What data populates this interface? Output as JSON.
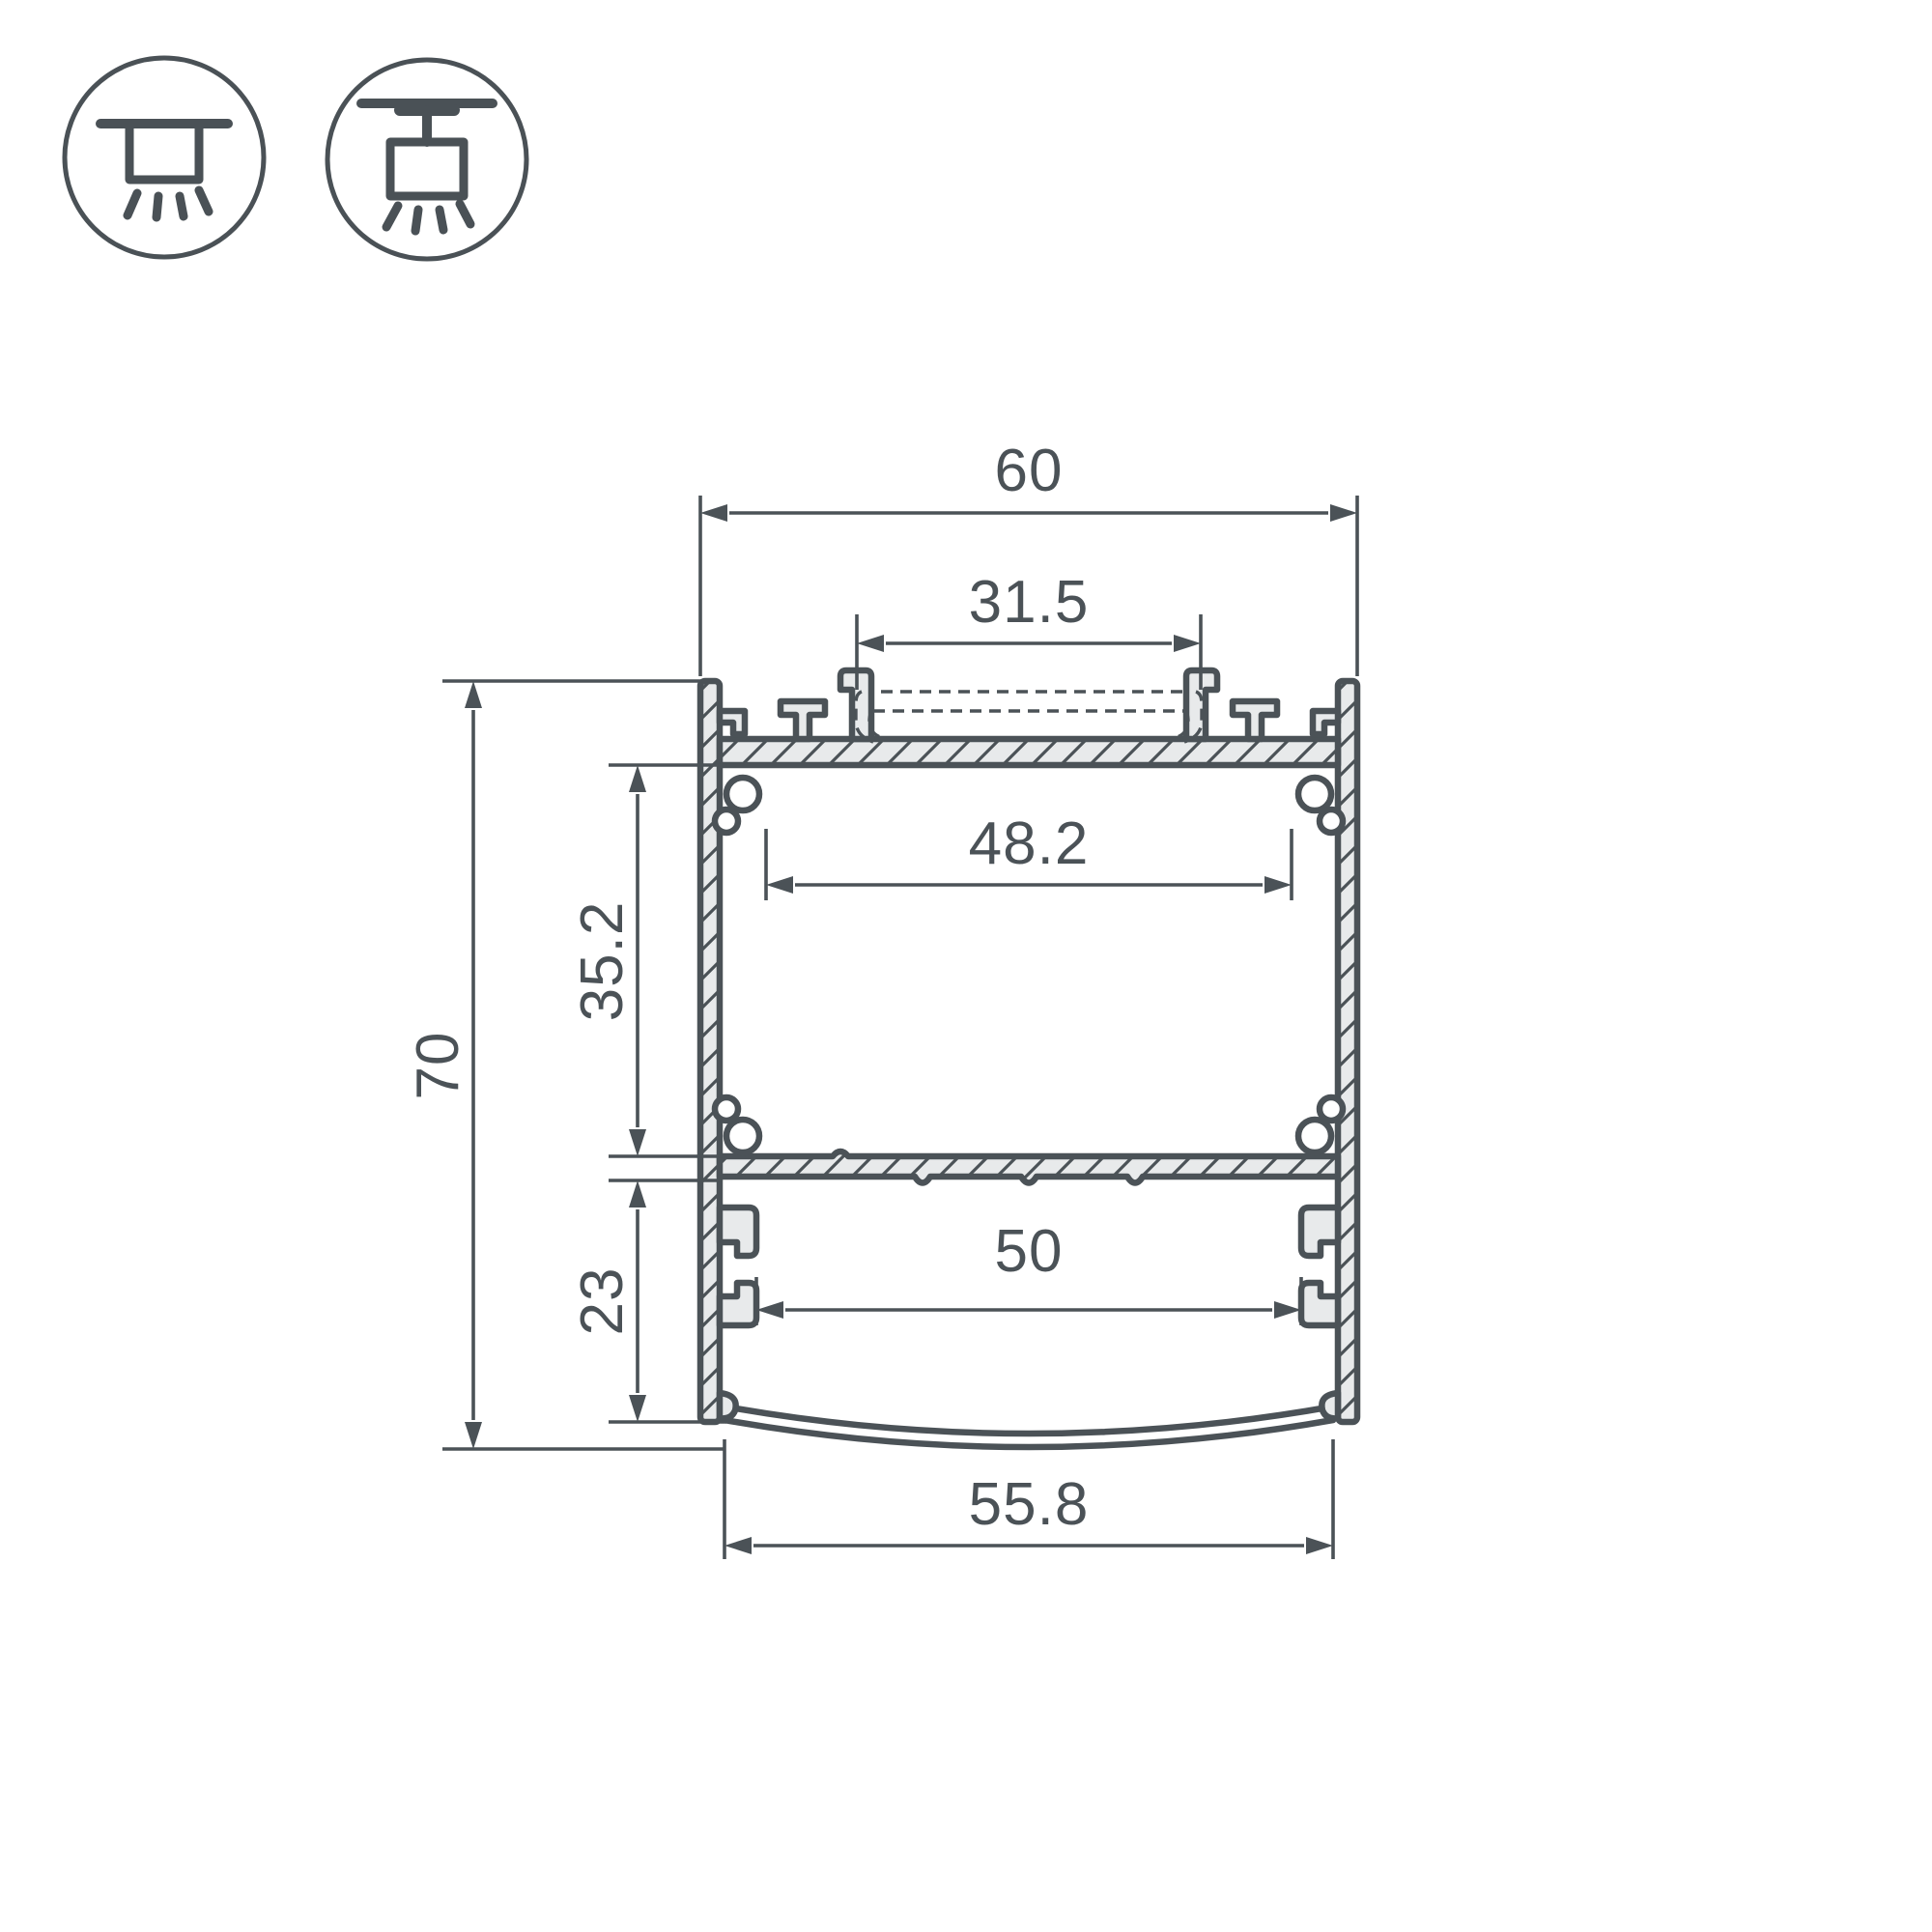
{
  "title": "LED profile cross-section technical drawing",
  "colors": {
    "background": "#ffffff",
    "line": "#4b5257",
    "aluminum_fill": "#e8eaeb",
    "text": "#4b5257"
  },
  "mount_icons": [
    {
      "name": "surface-mount-icon",
      "description": "ceiling surface mounted luminaire"
    },
    {
      "name": "pendant-mount-icon",
      "description": "suspended (pendant) mounted luminaire"
    }
  ],
  "dimensions": {
    "overall_width": "60",
    "cover_opening_width": "31.5",
    "inner_cavity_width": "48.2",
    "upper_cavity_height": "35.2",
    "overall_height": "70",
    "lower_cavity_height": "23",
    "lower_slot_width": "50",
    "diffuser_width": "55.8"
  }
}
